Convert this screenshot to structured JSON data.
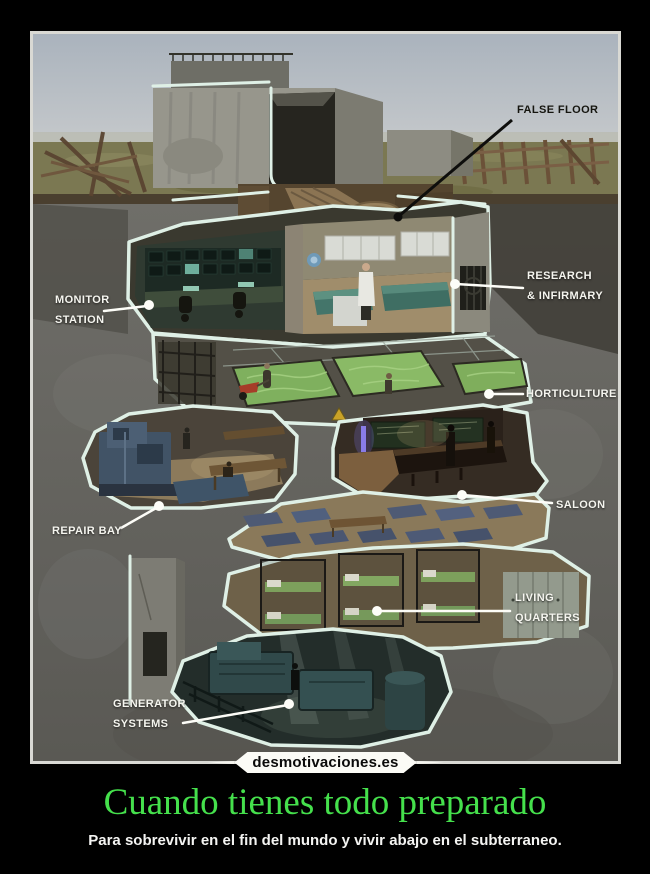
{
  "poster": {
    "watermark": "desmotivaciones.es",
    "title": "Cuando tienes todo preparado",
    "subtitle": "Para sobrevivir en el fin del mundo y vivir abajo en el subterraneo.",
    "colors": {
      "title_green": "#45e04c",
      "background": "#000000",
      "frame_border": "#d9d9d4",
      "outline_mint": "#dff0e6",
      "label_white": "#f5f5ef",
      "label_black": "#15150f"
    }
  },
  "diagram": {
    "labels": [
      {
        "id": "false-floor",
        "lines": [
          "FALSE FLOOR"
        ]
      },
      {
        "id": "monitor-station",
        "lines": [
          "MONITOR",
          "STATION"
        ]
      },
      {
        "id": "research-infirmary",
        "lines": [
          "RESEARCH",
          "& INFIRMARY"
        ]
      },
      {
        "id": "horticulture",
        "lines": [
          "HORTICULTURE"
        ]
      },
      {
        "id": "repair-bay",
        "lines": [
          "REPAIR BAY"
        ]
      },
      {
        "id": "saloon",
        "lines": [
          "SALOON"
        ]
      },
      {
        "id": "living-quarters",
        "lines": [
          "LIVING",
          "QUARTERS"
        ]
      },
      {
        "id": "generator-systems",
        "lines": [
          "GENERATOR",
          "SYSTEMS"
        ]
      }
    ]
  }
}
